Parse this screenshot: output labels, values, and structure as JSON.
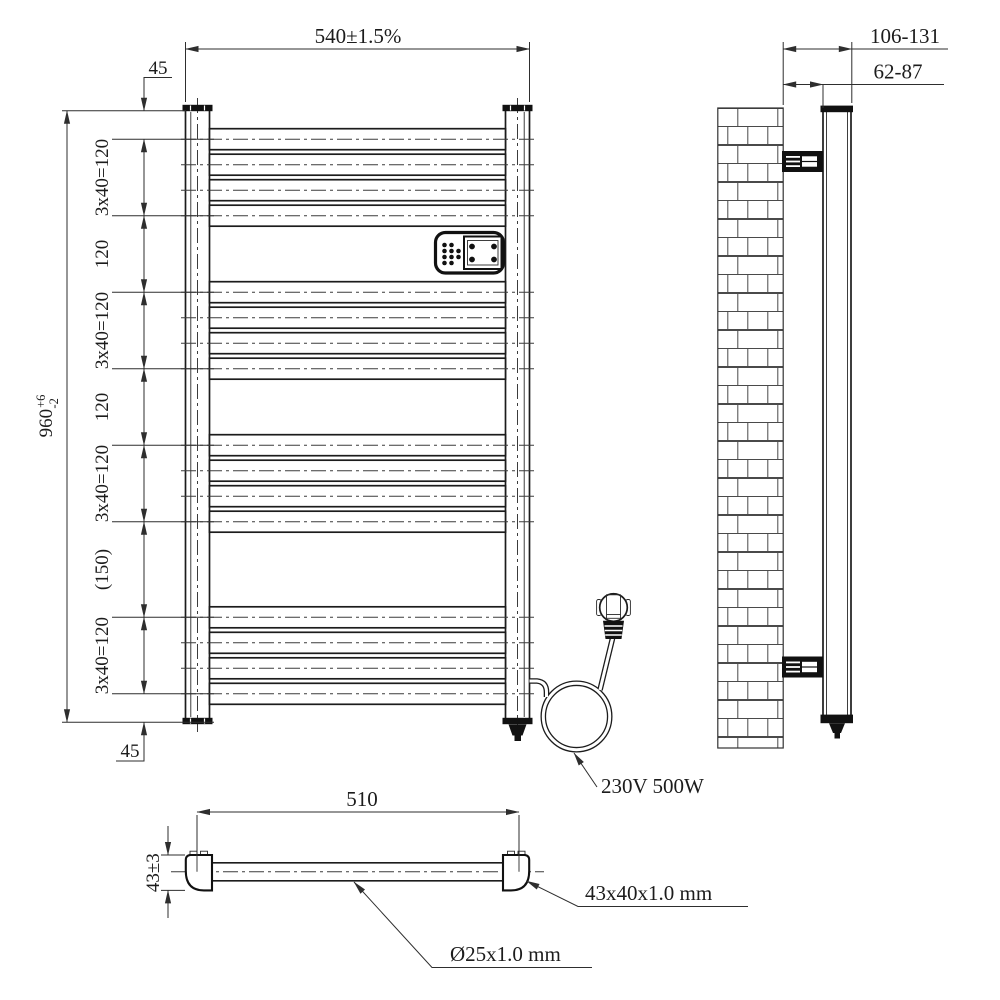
{
  "drawing": {
    "front": {
      "dim_width": "540±1.5%",
      "dim_top_offset": "45",
      "dim_bottom_offset": "45",
      "dim_bar_group": "3x40=120",
      "dim_gap": "120",
      "dim_center_gap": "(150)",
      "dim_height": "960",
      "dim_height_tol_up": "+6",
      "dim_height_tol_dn": "-2"
    },
    "side": {
      "dim_wall_to_front": "106-131",
      "dim_wall_to_back": "62-87"
    },
    "bottom": {
      "dim_centers": "510",
      "dim_profile_height": "43±3",
      "label_profile_spec": "43x40x1.0 mm",
      "label_tube_spec": "Ø25x1.0 mm"
    },
    "power": {
      "label_rating": "230V 500W"
    }
  }
}
